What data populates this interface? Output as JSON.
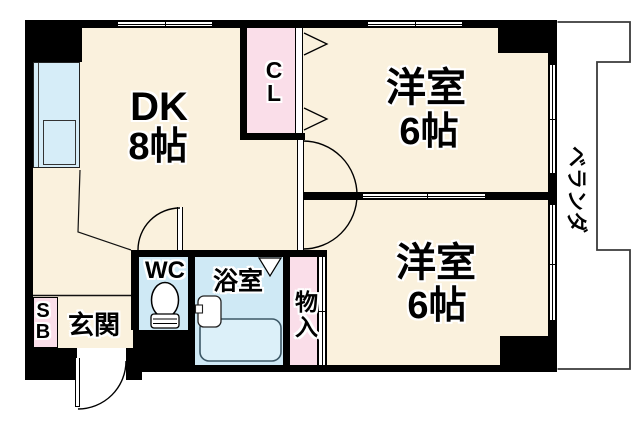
{
  "plan": {
    "rooms": {
      "dk": {
        "label": "DK",
        "size": "8帖"
      },
      "west_room_1": {
        "label": "洋室",
        "size": "6帖"
      },
      "west_room_2": {
        "label": "洋室",
        "size": "6帖"
      },
      "closet": {
        "label": "CL",
        "line1": "C",
        "line2": "L"
      },
      "toilet": {
        "label": "WC"
      },
      "bathroom": {
        "label": "浴室"
      },
      "storage": {
        "label": "物入"
      },
      "entrance": {
        "label": "玄関"
      },
      "shoe_box": {
        "label": "SB",
        "line1": "S",
        "line2": "B"
      },
      "veranda": {
        "label": "ベランダ"
      }
    },
    "colors": {
      "floor": "#FAF1DD",
      "closet_pink": "#FADEE9",
      "water_blue": "#CFE9F5",
      "wall": "#000000",
      "background": "#FFFFFF"
    }
  }
}
